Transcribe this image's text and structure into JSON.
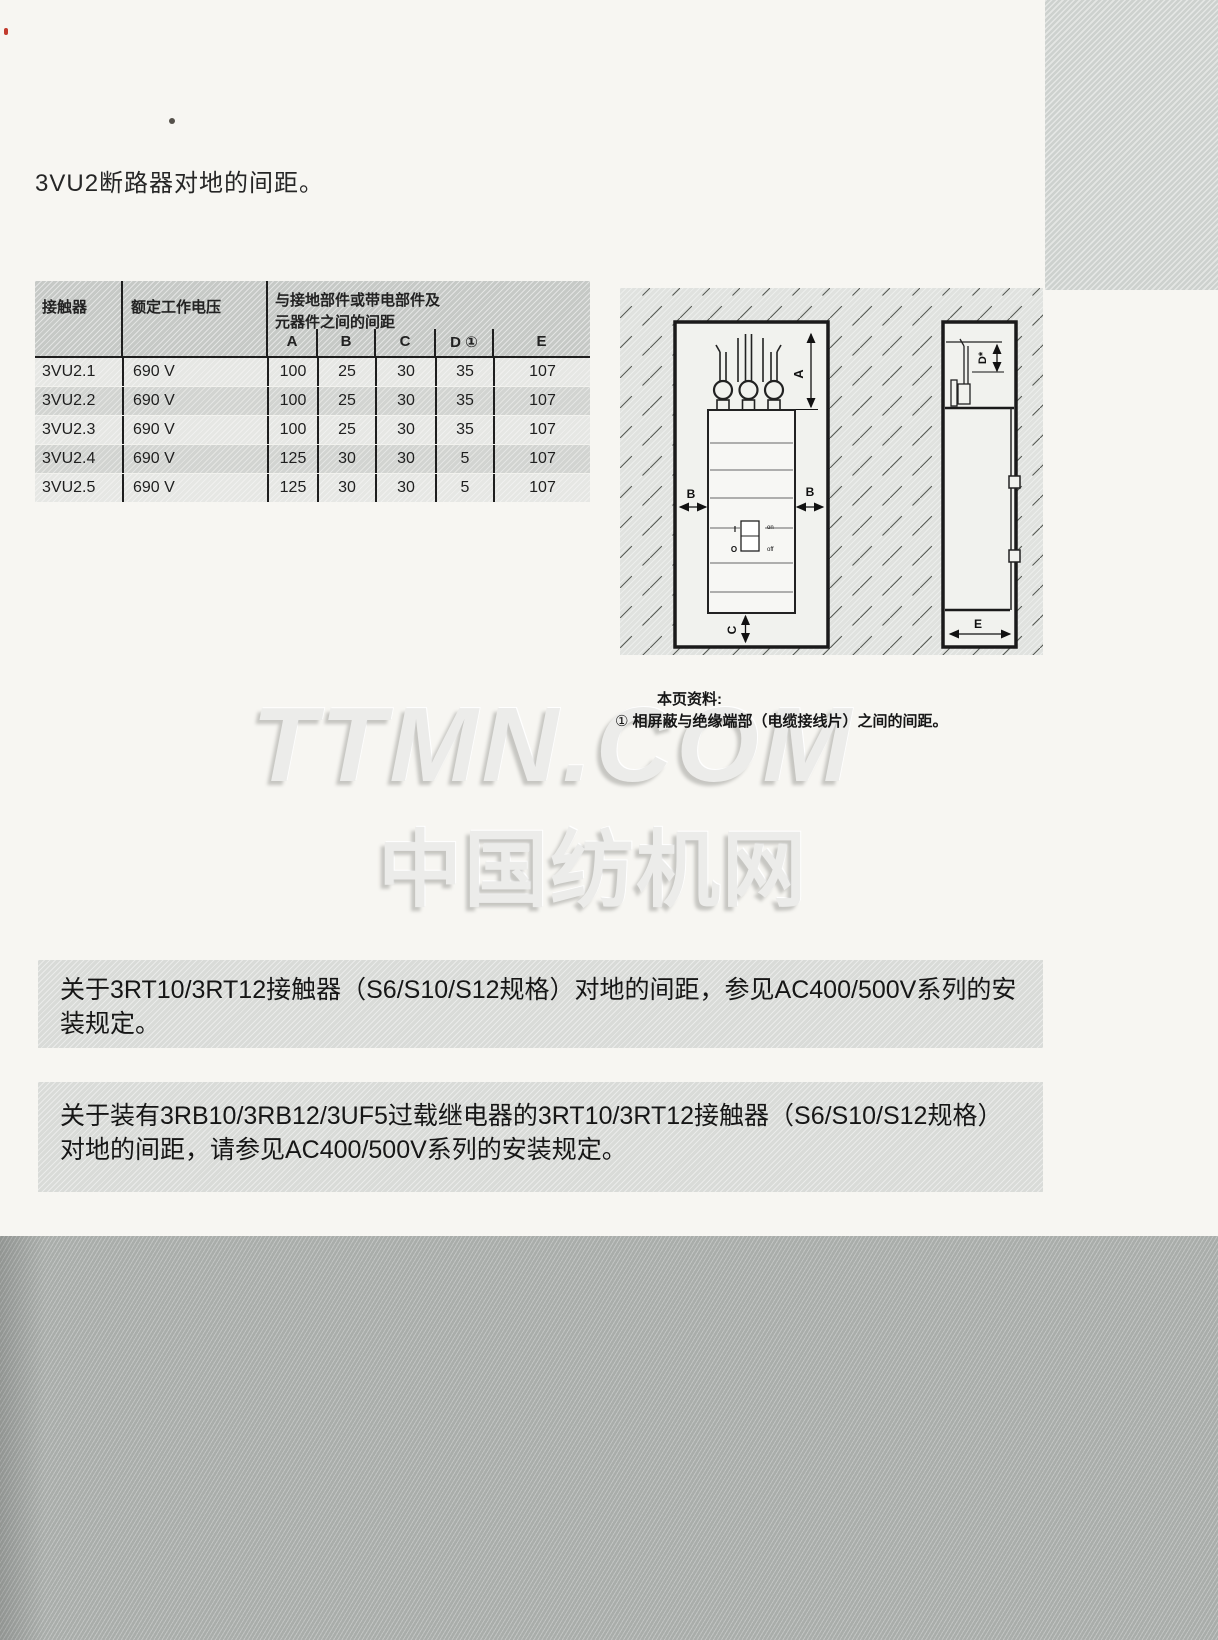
{
  "page": {
    "title": "3VU2断路器对地的间距。",
    "page_number": "43"
  },
  "table": {
    "header": {
      "contactor": "接触器",
      "voltage": "额定工作电压",
      "group_line1": "与接地部件或带电部件及",
      "group_line2": "元器件之间的间距",
      "dims": [
        "A",
        "B",
        "C",
        "D ①",
        "E"
      ]
    },
    "rows": [
      [
        "3VU2.1",
        "690 V",
        "100",
        "25",
        "30",
        "35",
        "107"
      ],
      [
        "3VU2.2",
        "690 V",
        "100",
        "25",
        "30",
        "35",
        "107"
      ],
      [
        "3VU2.3",
        "690 V",
        "100",
        "25",
        "30",
        "35",
        "107"
      ],
      [
        "3VU2.4",
        "690 V",
        "125",
        "30",
        "30",
        "5",
        "107"
      ],
      [
        "3VU2.5",
        "690 V",
        "125",
        "30",
        "30",
        "5",
        "107"
      ]
    ]
  },
  "diagram": {
    "a": "A",
    "b": "B",
    "c": "C",
    "d": "D*",
    "e": "E",
    "sw_i": "I",
    "sw_o": "O",
    "sw_on": "on",
    "sw_off": "off"
  },
  "footnote": {
    "heading": "本页资料:",
    "marker": "①",
    "text": "相屏蔽与绝缘端部（电缆接线片）之间的间距。"
  },
  "watermark": {
    "line1": "TTMN.COM",
    "line2": "中国纺机网"
  },
  "notes": [
    {
      "text": "关于3RT10/3RT12接触器（S6/S10/S12规格）对地的间距，参见AC400/500V系列的安装规定。"
    },
    {
      "text": "关于装有3RB10/3RB12/3UF5过载继电器的3RT10/3RT12接触器（S6/S10/S12规格）对地的间距，请参见AC400/500V系列的安装规定。"
    }
  ]
}
